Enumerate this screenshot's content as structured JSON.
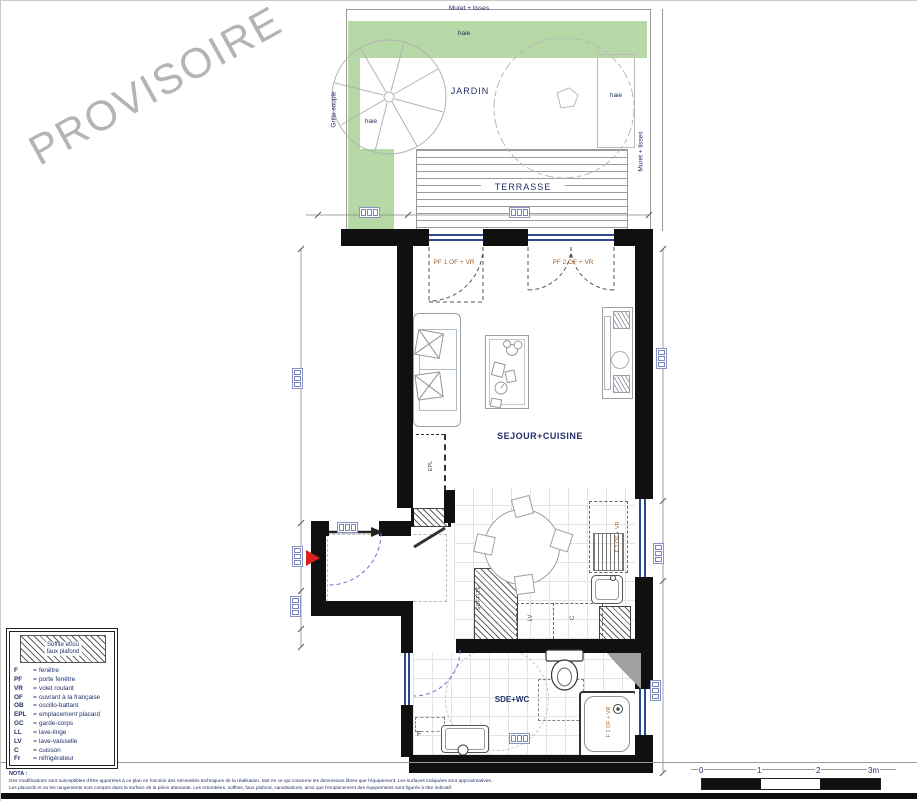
{
  "watermark": "PROVISOIRE",
  "garden": {
    "muret_top": "Muret + lisses",
    "muret_right": "Muret + lisses",
    "grille_souple": "Grille souple",
    "jardin": "JARDIN",
    "haie_top": "haie",
    "haie_left": "haie",
    "haie_right": "haie",
    "terrasse": "TERRASSE"
  },
  "rooms": {
    "living": "SEJOUR+CUISINE",
    "bath": "SDE+WC"
  },
  "openings": {
    "pf1": "PF 1 OF + VR",
    "pf2": "PF 2 OF + VR",
    "kitchen_window": "F 2 OF + VR",
    "shower_window": "F 1 OF + VR",
    "bath_window": "F"
  },
  "annotations": {
    "epl": "EPL",
    "soffite": "SOFFITE",
    "lv": "LV",
    "cuisson": "C"
  },
  "legend": {
    "eq": "=",
    "swatch_line1": "Soffite et/ou",
    "swatch_line2": "faux plafond",
    "items": [
      {
        "abbr": "F",
        "def": "fenêtre"
      },
      {
        "abbr": "PF",
        "def": "porte fenêtre"
      },
      {
        "abbr": "VR",
        "def": "volet roulant"
      },
      {
        "abbr": "OF",
        "def": "ouvrant à la française"
      },
      {
        "abbr": "OB",
        "def": "oscillo-battant"
      },
      {
        "abbr": "EPL",
        "def": "emplacement placard"
      },
      {
        "abbr": "GC",
        "def": "garde-corps"
      },
      {
        "abbr": "LL",
        "def": "lave-linge"
      },
      {
        "abbr": "LV",
        "def": "lave-vaisselle"
      },
      {
        "abbr": "C",
        "def": "cuisson"
      },
      {
        "abbr": "Fr",
        "def": "réfrigérateur"
      }
    ]
  },
  "nota": {
    "title": "NOTA :",
    "line1": "Des modifications sont susceptibles d'être apportées à ce plan en fonction des nécessités techniques de la réalisation, tant en ce qui concerne les dimensions libres que l'équipement. Les surfaces indiquées sont approximatives.",
    "line2": "Les placards et ou les rangements sont compris dans la surface de la pièce attenante. Les retombées, soffites, faux plafond, canalisations, ainsi que l'emplacement des équipements sont figurés à titre indicatif."
  },
  "scalebar": {
    "labels": [
      "0",
      "1",
      "2",
      "3m"
    ]
  },
  "colors": {
    "wall": "#101010",
    "green": "#b5d8a6",
    "navy_label": "#223069",
    "opening_label": "#a5622d",
    "door_arc_blue": "#6a6fd0",
    "entry_arrow_red": "#d5221d"
  }
}
